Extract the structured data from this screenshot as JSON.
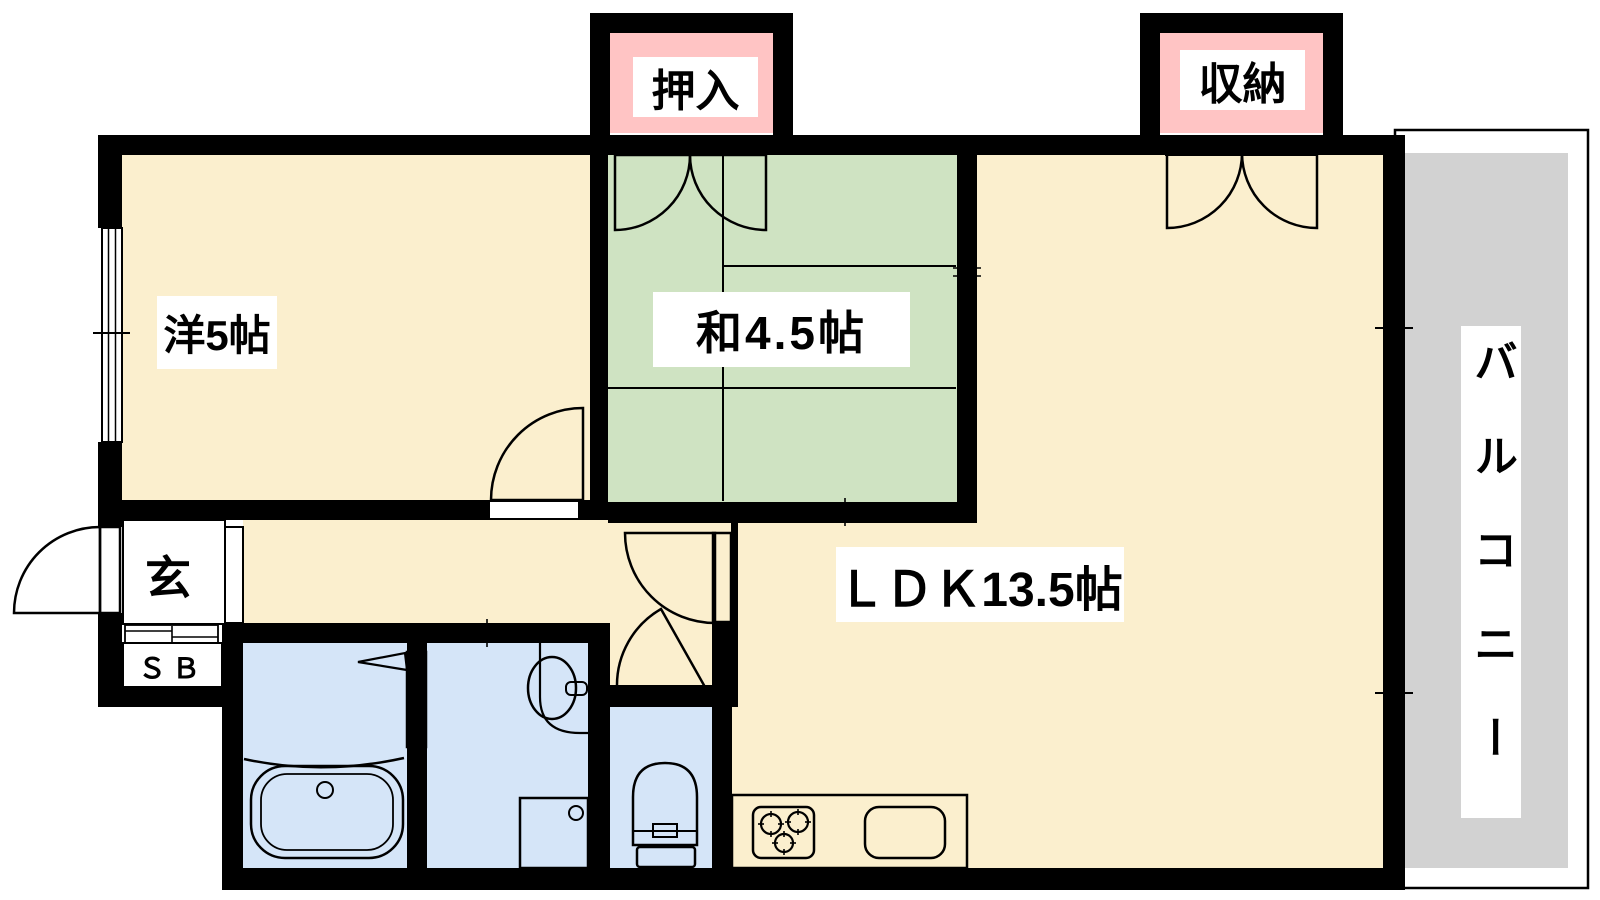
{
  "plan": {
    "rooms": {
      "western": {
        "label": "洋5帖"
      },
      "japanese": {
        "label": "和4.5帖"
      },
      "ldk": {
        "label": "ＬＤＫ13.5帖"
      },
      "balcony": {
        "label": "バルコニー"
      },
      "entrance": {
        "label": "玄"
      },
      "shoe_box": {
        "label": "ＳＢ"
      },
      "closet": {
        "label": "押入"
      },
      "storage": {
        "label": "収納"
      }
    },
    "colors": {
      "floor_cream": "#FBEFCE",
      "tatami_green": "#CFE3C2",
      "wet_area_blue": "#D5E5F8",
      "kitchen_purple": "#E6D9EE",
      "balcony_gray": "#D2D2D2",
      "entrance_gray": "#CACACA",
      "label_pink": "#FFC4C4",
      "wall_black": "#000000"
    }
  }
}
